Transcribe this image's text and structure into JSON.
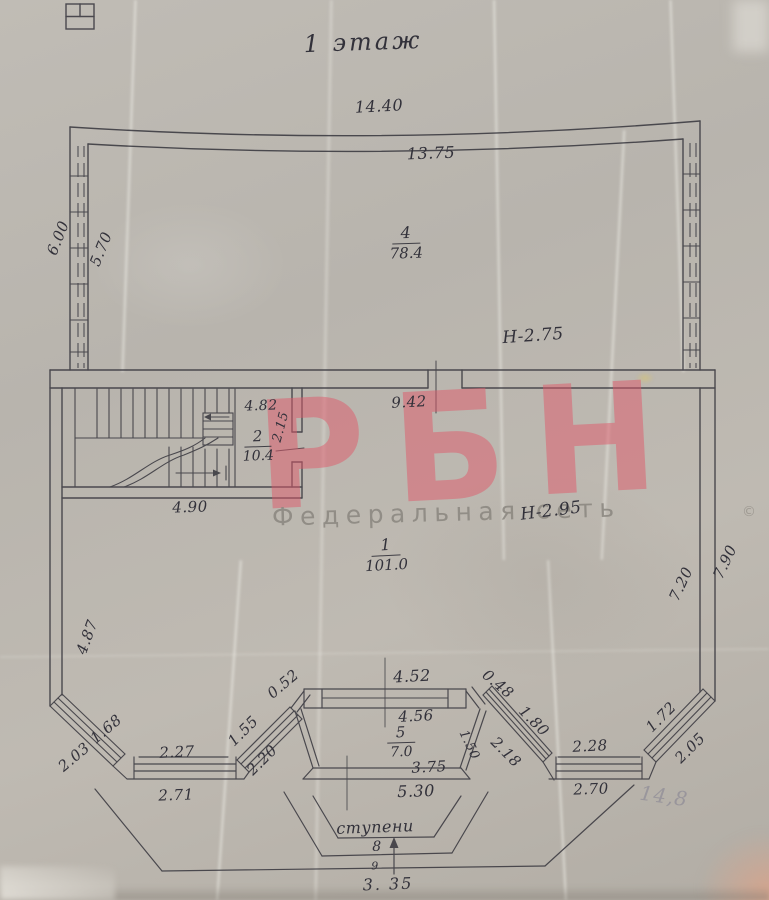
{
  "title": "1 этаж",
  "watermark": {
    "logo": "РБН",
    "subtitle": "Федеральная сеть",
    "copyright": "©"
  },
  "colors": {
    "watermark": "#df5a6b",
    "watermark_subtitle": "#8a867f",
    "ink": "#32313a"
  },
  "rooms": {
    "r4": {
      "number": "4",
      "area": "78.4"
    },
    "r2": {
      "number": "2",
      "area": "10.4"
    },
    "r1": {
      "number": "1",
      "area": "101.0"
    },
    "r5": {
      "number": "5",
      "area": "7.0"
    }
  },
  "heights": {
    "upper_hall": "H-2.75",
    "lower_hall": "H-2.95"
  },
  "dims": {
    "top_outer": "14.40",
    "top_inner": "13.75",
    "left_upper_outer": "6.00",
    "left_upper_inner": "5.70",
    "stair_top": "4.82",
    "stair_side": "2.15",
    "stair_bottom": "4.90",
    "entry_opening": "9.42",
    "left_lower": "4.87",
    "right_lower_inner": "7.20",
    "right_lower_outer": "7.90",
    "bay_left_diag_inner": "1.68",
    "bay_left_diag_outer": "2.03",
    "bay_left_front_inner": "2.27",
    "bay_left_front_outer": "2.71",
    "bay_left_return_inner": "1.55",
    "bay_left_return_outer": "2.20",
    "porch_pier_left": "0.52",
    "porch_front_outer": "4.52",
    "porch_pier_right": "0.48",
    "porch_front_inner": "4.56",
    "porch_side_right": "1.50",
    "porch_back_inner": "3.75",
    "porch_back_outer": "5.30",
    "bay_right_diag_inner": "1.80",
    "bay_right_diag_outer": "2.18",
    "bay_right_front_inner": "2.28",
    "bay_right_front_outer": "2.70",
    "bay_right_return_inner": "1.72",
    "bay_right_return_outer": "2.05",
    "steps_width": "3. 35"
  },
  "steps": {
    "label": "ступени",
    "count": "8",
    "mark": "9"
  },
  "notes": {
    "pencil": "14,8"
  }
}
